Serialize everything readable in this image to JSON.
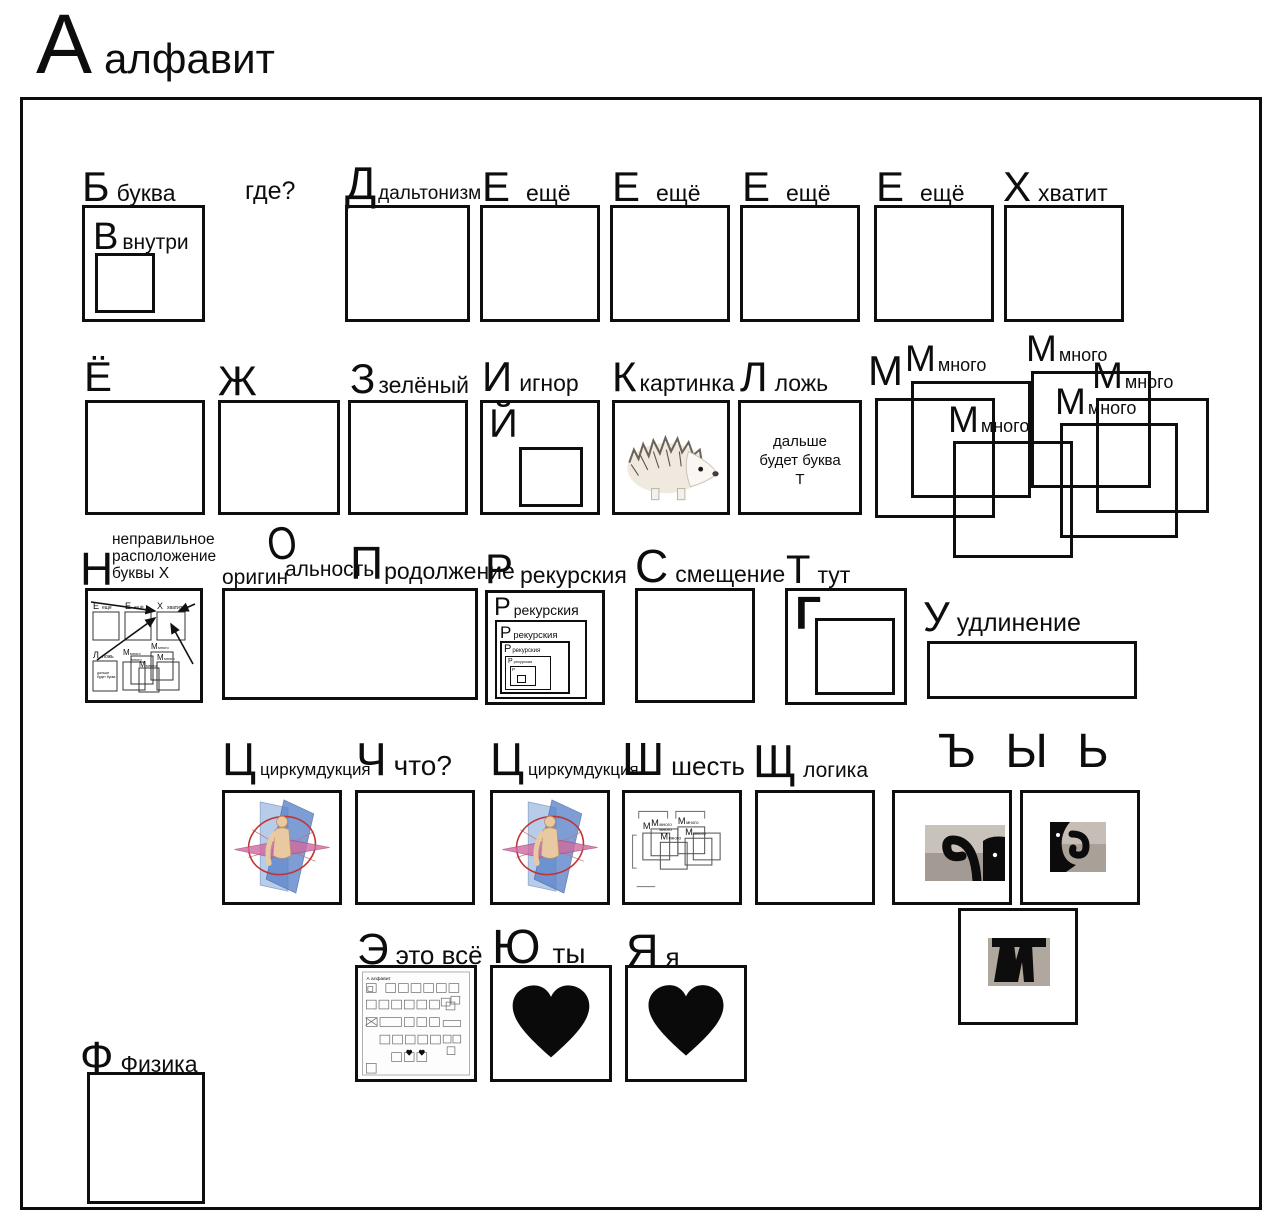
{
  "title": {
    "letter": "А",
    "word": "алфавит"
  },
  "cells": {
    "b": {
      "letter": "Б",
      "word": "буква"
    },
    "v": {
      "letter": "В",
      "word": "внутри"
    },
    "gde": {
      "text": "где?"
    },
    "d": {
      "letter": "Д",
      "word": "дальтонизм"
    },
    "e": {
      "letter": "Е",
      "word": "ещё"
    },
    "h": {
      "letter": "Х",
      "word": "хватит"
    },
    "yo": {
      "letter": "Ё"
    },
    "zh": {
      "letter": "Ж"
    },
    "z": {
      "letter": "З",
      "word": "зелёный"
    },
    "i": {
      "letter": "И",
      "word": "игнор",
      "inner_letter": "Й"
    },
    "k": {
      "letter": "К",
      "word": "картинка"
    },
    "l": {
      "letter": "Л",
      "word": "ложь",
      "inner_line1": "дальше",
      "inner_line2": "будет буква",
      "inner_line3": "Т"
    },
    "m": {
      "letter": "М",
      "word": "много"
    },
    "n": {
      "letter": "Н",
      "word_line1": "неправильное",
      "word_line2": "расположение",
      "word_line3": "буквы Х"
    },
    "o": {
      "letter": "О",
      "word_start": "оригин",
      "word_end": "альность"
    },
    "p": {
      "letter": "П",
      "word": "родолжение"
    },
    "r": {
      "letter": "Р",
      "word": "рекурския"
    },
    "s": {
      "letter": "С",
      "word": "смещение"
    },
    "t": {
      "letter": "Т",
      "word": "тут",
      "inner_letter": "Г"
    },
    "u": {
      "letter": "У",
      "word": "удлинение"
    },
    "ts": {
      "letter": "Ц",
      "word": "циркумдукция"
    },
    "ch": {
      "letter": "Ч",
      "word": "что?"
    },
    "sh": {
      "letter": "Ш",
      "word": "шесть"
    },
    "shch": {
      "letter": "Щ",
      "word": "логика"
    },
    "signs": {
      "letters": "Ъ Ы Ь"
    },
    "eh": {
      "letter": "Э",
      "word": "это всё",
      "mini_title": "А алфавит"
    },
    "yu": {
      "letter": "Ю",
      "word": "ты"
    },
    "ya": {
      "letter": "Я",
      "word": "я"
    },
    "f": {
      "letter": "Ф",
      "word": "Физика"
    }
  },
  "colors": {
    "ink": "#0d0d0d",
    "photo_gray": "#b3aaa2",
    "plane_blue": "#5b82c9",
    "plane_lightblue": "#aac4e4",
    "plane_pink": "#d06aa0",
    "ring_red": "#c23333",
    "skin": "#e9c9a2"
  }
}
